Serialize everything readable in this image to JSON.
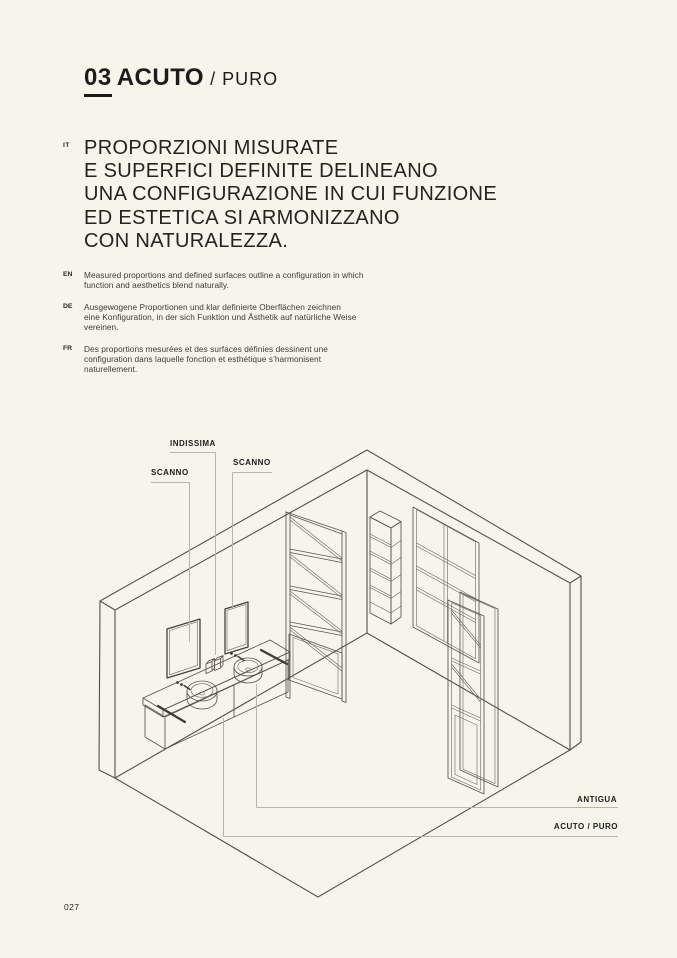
{
  "page": {
    "background": "#f7f4ec",
    "ink": "#1c1c1a",
    "drawing_line": "#55514a",
    "leader_line": "#bab4a8"
  },
  "header": {
    "index": "03",
    "title": "ACUTO",
    "separator": "/",
    "variant": "PURO"
  },
  "intro": {
    "it_label": "IT",
    "headline": "PROPORZIONI MISURATE\nE SUPERFICI DEFINITE DELINEANO\nUNA CONFIGURAZIONE IN CUI FUNZIONE\nED ESTETICA SI ARMONIZZANO\nCON NATURALEZZA.",
    "translations": [
      {
        "label": "EN",
        "text": "Measured proportions and defined surfaces outline a configuration in which\nfunction and aesthetics blend naturally."
      },
      {
        "label": "DE",
        "text": "Ausgewogene Proportionen und klar definierte Oberflächen zeichnen\neine Konfiguration, in der sich Funktion und Ästhetik auf natürliche Weise\nvereinen."
      },
      {
        "label": "FR",
        "text": "Des proportions mesurées et des surfaces définies dessinent une\nconfiguration dans laquelle fonction et esthétique s’harmonisent\nnaturellement."
      }
    ]
  },
  "diagram": {
    "labels": [
      {
        "id": "indissima",
        "text": "INDISSIMA"
      },
      {
        "id": "scanno-left",
        "text": "SCANNO"
      },
      {
        "id": "scanno-right",
        "text": "SCANNO"
      },
      {
        "id": "antigua",
        "text": "ANTIGUA"
      },
      {
        "id": "acuto-puro",
        "text": "ACUTO / PURO"
      }
    ]
  },
  "footer": {
    "page_number": "027"
  }
}
